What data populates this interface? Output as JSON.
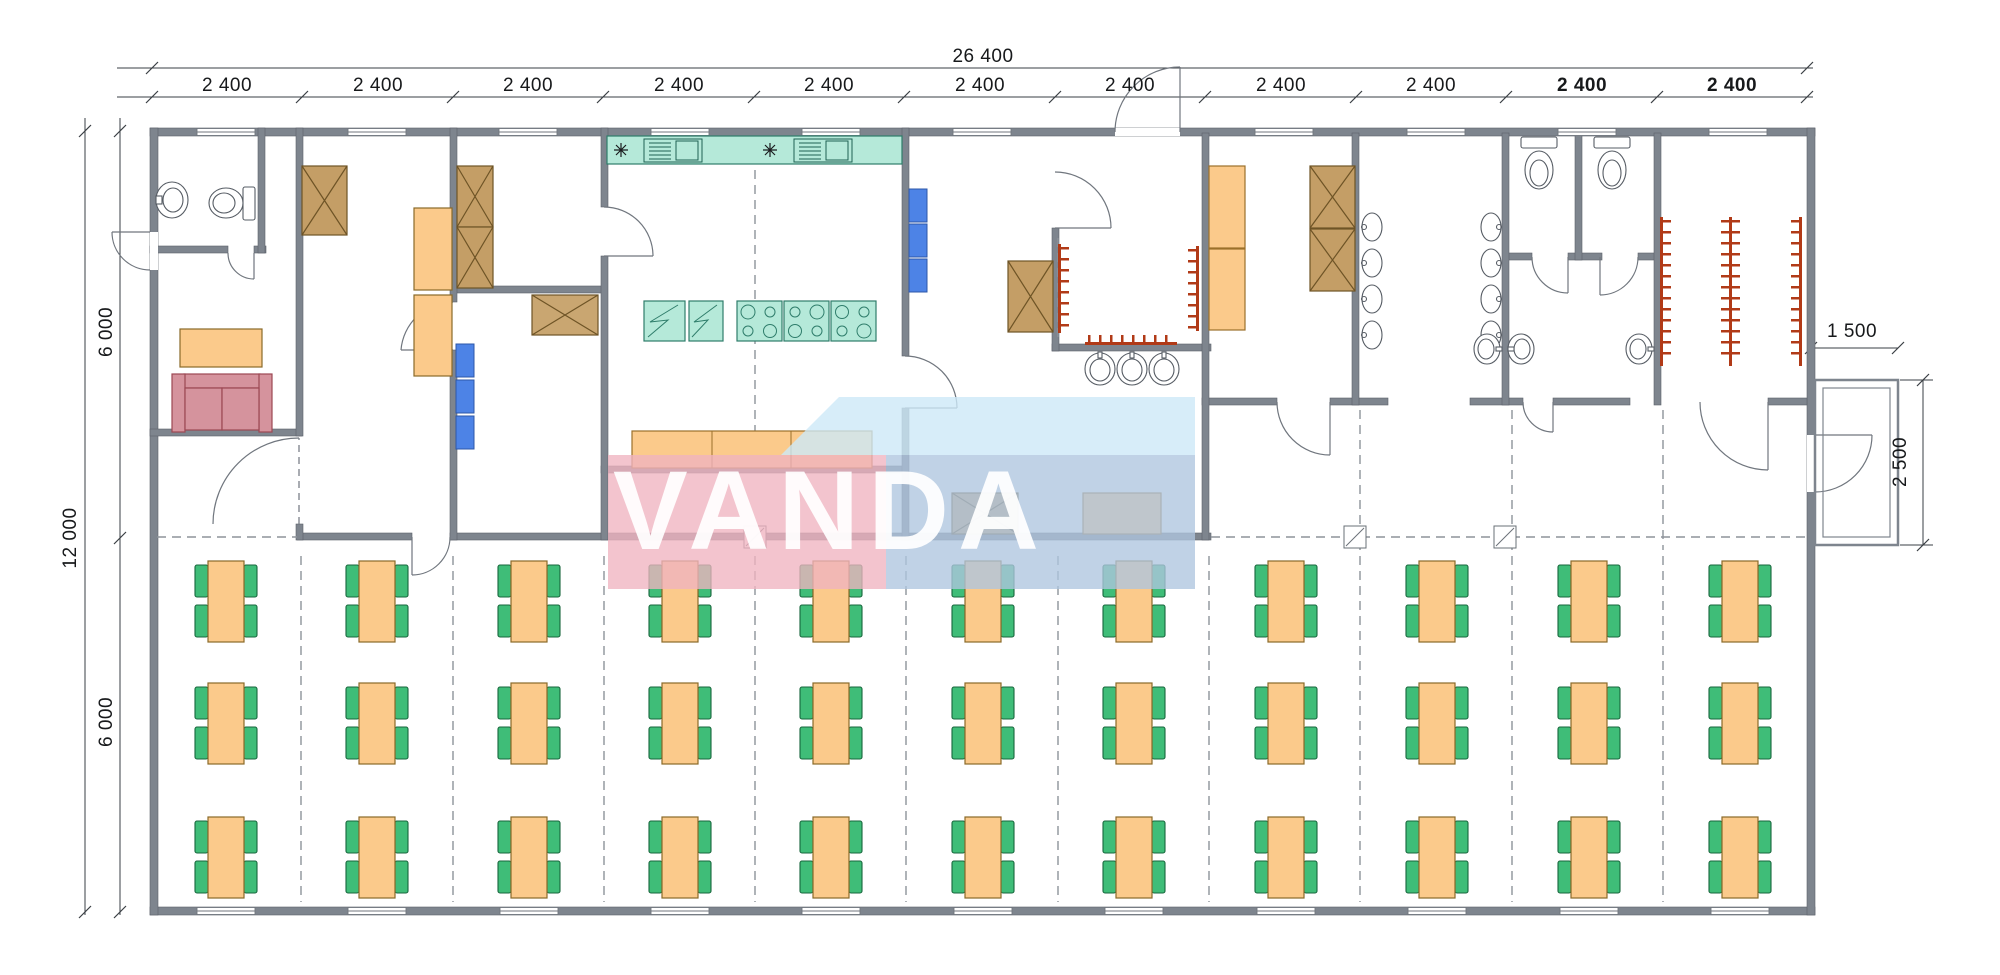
{
  "watermark": {
    "text": "VANDA"
  },
  "dimensions": {
    "overall_width": "26 400",
    "overall_height": "12 000",
    "top_segments": [
      "2 400",
      "2 400",
      "2 400",
      "2 400",
      "2 400",
      "2 400",
      "2 400",
      "2 400",
      "2 400",
      "2 400",
      "2 400"
    ],
    "left_segments": [
      "6 000",
      "6 000"
    ],
    "porch_width": "1 500",
    "porch_depth": "2 500"
  },
  "colors": {
    "wall": "#7e858e",
    "furniture_orange": "#fbca8b",
    "chair_green": "#3fbd78",
    "chair_green_edge": "#17663c",
    "table_edge": "#8a6a28",
    "cabinet_brown": "#c49e66",
    "locker_blue": "#4d83e6",
    "kitchen_teal": "#b5e9d9",
    "sofa_pink": "#d5939d",
    "hook_red": "#b13a17",
    "line_gray": "#6a7077",
    "watermark_pink": "#f0b3c0",
    "watermark_blue": "#aec5df",
    "watermark_sky": "#cde8f8"
  },
  "dining": {
    "rows": 3,
    "columns": 11,
    "tables_total": 33,
    "chairs_per_table": 4
  }
}
